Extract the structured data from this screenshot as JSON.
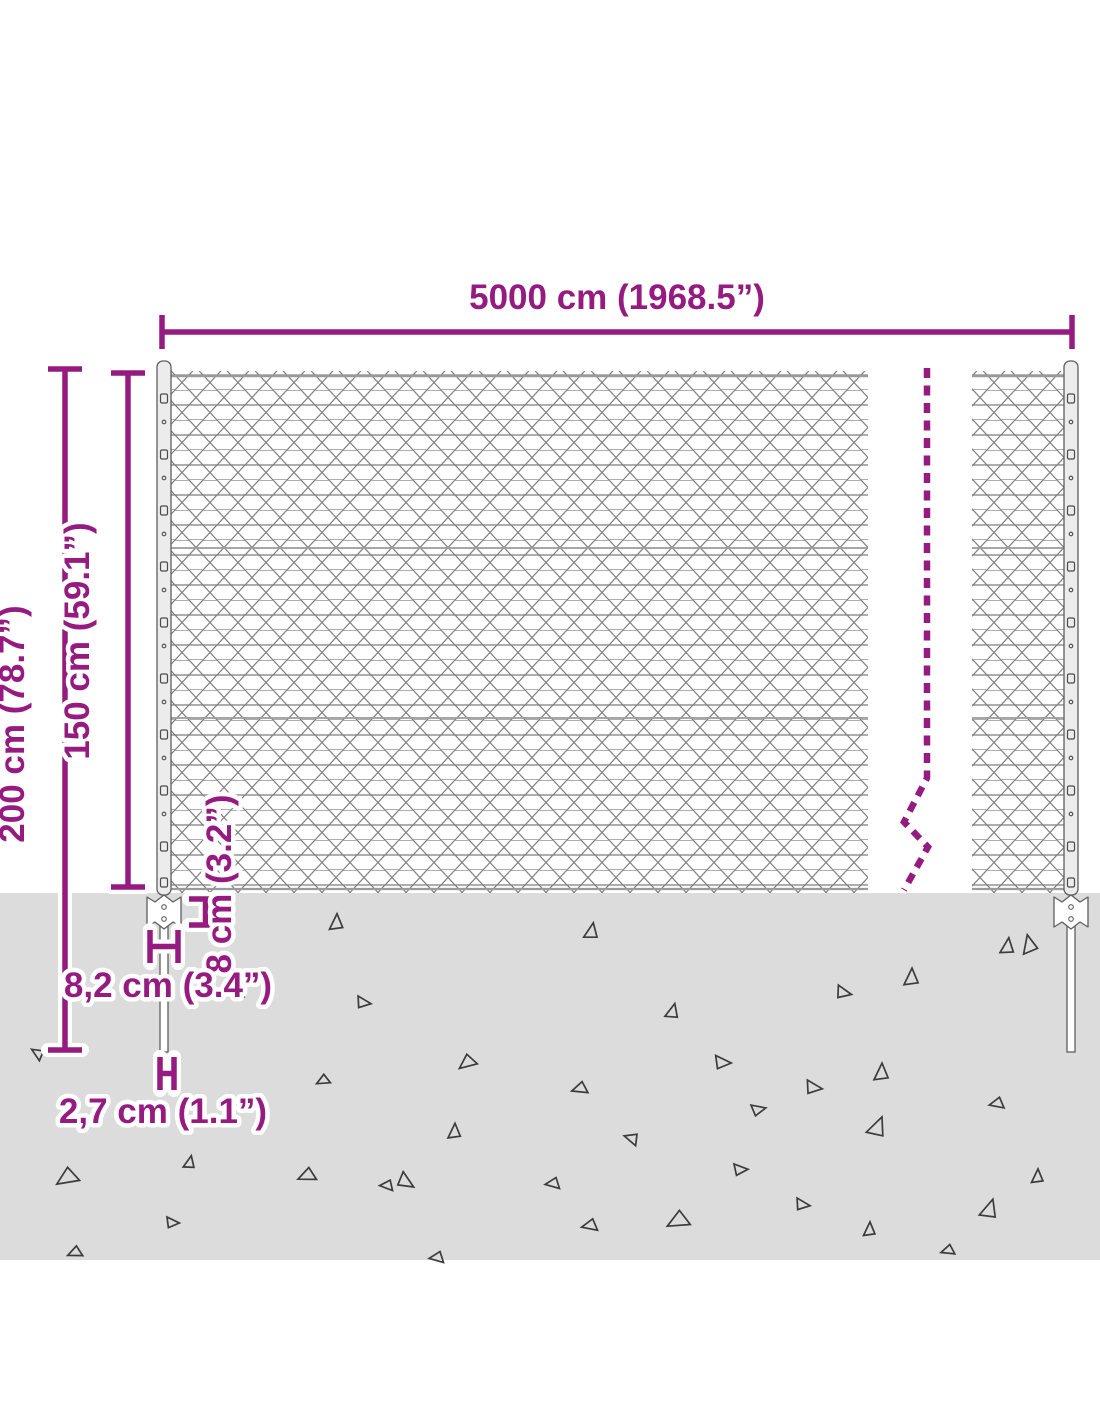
{
  "diagram": {
    "accent_color": "#951b81",
    "ground_color": "#dcdcdc",
    "mesh_color": "#7d7d7d",
    "labels": {
      "total_width": "5000 cm (1968.5”)",
      "total_height": "200 cm (78.7”)",
      "mesh_height": "150 cm (59.1”)",
      "anchor_plate_height": "8 cm (3.2”)",
      "anchor_plate_width": "8,2 cm (3.4”)",
      "spike_diameter": "2,7 cm (1.1”)"
    }
  }
}
